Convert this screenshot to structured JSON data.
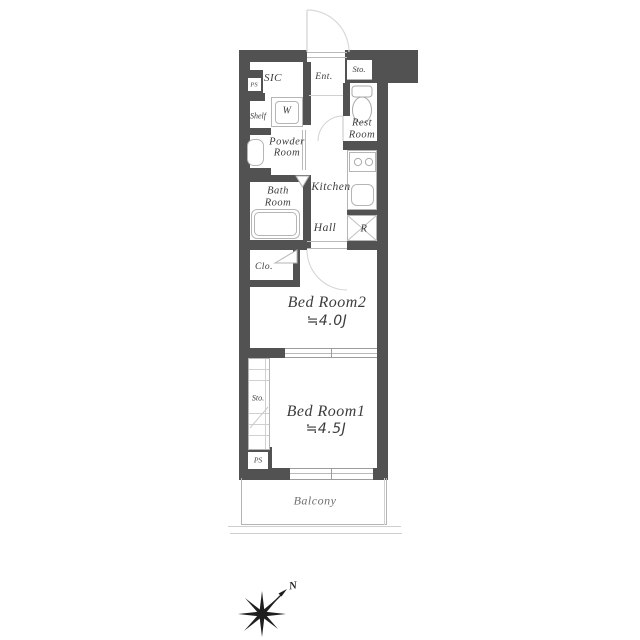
{
  "title": "apartment-floor-plan",
  "colors": {
    "wall": "#525252",
    "fixture_line": "#b5b5b5",
    "door_arc": "#d2d2d2",
    "window_line": "#9c9c9c",
    "text": "#3c3c3c",
    "balcony_line": "#b4b4b4",
    "compass": "#1f1f1f"
  },
  "rooms": {
    "sic": {
      "label": "SIC"
    },
    "ps_top": {
      "label": "PS"
    },
    "shelf": {
      "label": "Shelf"
    },
    "washer": {
      "label": "W"
    },
    "powder_room": {
      "label_line1": "Powder",
      "label_line2": "Room"
    },
    "entrance": {
      "label": "Ent."
    },
    "storage_top": {
      "label": "Sto."
    },
    "rest_room": {
      "label_line1": "Rest",
      "label_line2": "Room"
    },
    "bath_room": {
      "label_line1": "Bath",
      "label_line2": "Room"
    },
    "kitchen": {
      "label": "Kitchen"
    },
    "hall": {
      "label": "Hall"
    },
    "refrigerator": {
      "label": "R"
    },
    "closet": {
      "label": "Clo."
    },
    "bedroom2": {
      "label": "Bed Room2",
      "size": "≒4.0J"
    },
    "storage_left": {
      "label": "Sto."
    },
    "bedroom1": {
      "label": "Bed Room1",
      "size": "≒4.5J"
    },
    "ps_bottom": {
      "label": "PS"
    },
    "balcony": {
      "label": "Balcony"
    }
  },
  "compass": {
    "north_label": "N"
  }
}
